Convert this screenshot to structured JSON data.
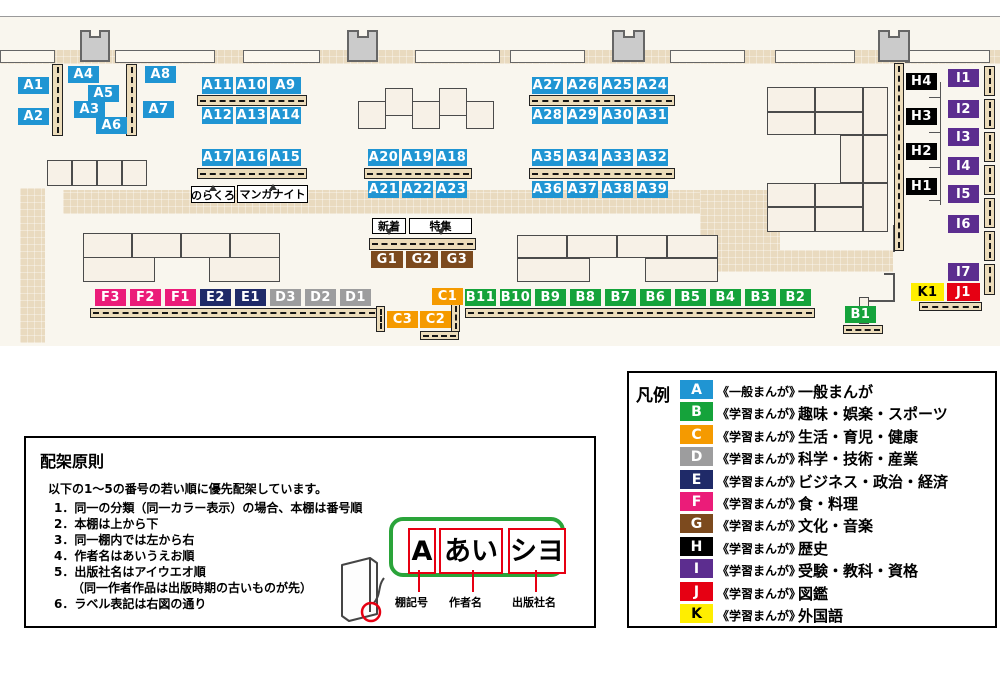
{
  "legend": {
    "title": "凡例",
    "entries": [
      {
        "key": "A",
        "color": "#2095d3",
        "letter": "#ffffff",
        "scope": "《一般まんが》",
        "category": "一般まんが"
      },
      {
        "key": "B",
        "color": "#15a33b",
        "letter": "#ffffff",
        "scope": "《学習まんが》",
        "category": "趣味・娯楽・スポーツ"
      },
      {
        "key": "C",
        "color": "#f59a00",
        "letter": "#ffffff",
        "scope": "《学習まんが》",
        "category": "生活・育児・健康"
      },
      {
        "key": "D",
        "color": "#9d9d9e",
        "letter": "#ffffff",
        "scope": "《学習まんが》",
        "category": "科学・技術・産業"
      },
      {
        "key": "E",
        "color": "#1f2a68",
        "letter": "#ffffff",
        "scope": "《学習まんが》",
        "category": "ビジネス・政治・経済"
      },
      {
        "key": "F",
        "color": "#eb1c79",
        "letter": "#ffffff",
        "scope": "《学習まんが》",
        "category": "食・料理"
      },
      {
        "key": "G",
        "color": "#7c4a1e",
        "letter": "#ffffff",
        "scope": "《学習まんが》",
        "category": "文化・音楽"
      },
      {
        "key": "H",
        "color": "#000000",
        "letter": "#ffffff",
        "scope": "《学習まんが》",
        "category": "歴史"
      },
      {
        "key": "I",
        "color": "#5c2d8f",
        "letter": "#ffffff",
        "scope": "《学習まんが》",
        "category": "受験・教科・資格"
      },
      {
        "key": "J",
        "color": "#e60013",
        "letter": "#ffffff",
        "scope": "《学習まんが》",
        "category": "図鑑"
      },
      {
        "key": "K",
        "color": "#ffee00",
        "letter": "#000000",
        "scope": "《学習まんが》",
        "category": "外国語"
      }
    ]
  },
  "principles": {
    "title": "配架原則",
    "intro": "以下の1～5の番号の若い順に優先配架しています。",
    "items": [
      "1．同一の分類（同一カラー表示）の場合、本棚は番号順",
      "2．本棚は上から下",
      "3．同一棚内では左から右",
      "4．作者名はあいうえお順",
      "5．出版社名はアイウエオ順",
      "　　（同一作者作品は出版時期の古いものが先）",
      "6．ラベル表記は右図の通り"
    ],
    "label_example": {
      "parts": [
        {
          "text": "A",
          "caption": "棚記号",
          "box": [
            15,
            7,
            28,
            46
          ],
          "cap_x": 369,
          "line_x": 392
        },
        {
          "text": "あい",
          "caption": "作者名",
          "box": [
            46,
            7,
            64,
            46
          ],
          "cap_x": 423,
          "line_x": 446
        },
        {
          "text": "シヨ",
          "caption": "出版社名",
          "box": [
            115,
            7,
            58,
            46
          ],
          "cap_x": 486,
          "line_x": 509
        }
      ],
      "cap_y": 156,
      "line_y": 132,
      "line_h": 22
    }
  },
  "map": {
    "colors": {
      "A": "#2095d3",
      "B": "#15a33b",
      "C": "#f59a00",
      "D": "#9d9d9e",
      "E": "#1f2a68",
      "F": "#eb1c79",
      "G": "#7c4a1e",
      "H": "#000000",
      "I": "#5c2d8f",
      "J": "#e60013",
      "K": "#ffee00"
    },
    "floor": [
      0,
      16,
      1000,
      330
    ],
    "topline": [
      0,
      16,
      1000,
      1
    ],
    "walkways": [
      [
        0,
        50,
        1000,
        14
      ],
      [
        63,
        190,
        660,
        24
      ],
      [
        700,
        190,
        80,
        82
      ],
      [
        700,
        250,
        193,
        22
      ],
      [
        20,
        188,
        25,
        155
      ]
    ],
    "walls": [
      [
        0,
        50,
        55,
        13
      ],
      [
        115,
        50,
        100,
        13
      ],
      [
        243,
        50,
        77,
        13
      ],
      [
        415,
        50,
        85,
        13
      ],
      [
        510,
        50,
        75,
        13
      ],
      [
        670,
        50,
        75,
        13
      ],
      [
        775,
        50,
        80,
        13
      ],
      [
        905,
        50,
        85,
        13
      ]
    ],
    "pillars": [
      [
        80,
        30,
        30,
        32
      ],
      [
        347,
        30,
        31,
        32
      ],
      [
        612,
        30,
        33,
        32
      ],
      [
        878,
        30,
        32,
        32
      ]
    ],
    "lines": [
      [
        893,
        225,
        2,
        27
      ],
      [
        893,
        274,
        2,
        28
      ],
      [
        884,
        273,
        11,
        2
      ],
      [
        868,
        300,
        27,
        2
      ],
      [
        940,
        82,
        1,
        123
      ],
      [
        929,
        97,
        11,
        1
      ],
      [
        929,
        132,
        11,
        1
      ],
      [
        929,
        167,
        11,
        1
      ],
      [
        929,
        200,
        11,
        1
      ]
    ],
    "tables": [
      [
        47,
        160,
        25,
        26
      ],
      [
        72,
        160,
        25,
        26
      ],
      [
        97,
        160,
        25,
        26
      ],
      [
        122,
        160,
        25,
        26
      ],
      [
        358,
        101,
        28,
        28
      ],
      [
        385,
        88,
        28,
        28
      ],
      [
        412,
        101,
        28,
        28
      ],
      [
        439,
        88,
        28,
        28
      ],
      [
        466,
        101,
        28,
        28
      ],
      [
        83,
        233,
        49,
        25
      ],
      [
        132,
        233,
        49,
        25
      ],
      [
        181,
        233,
        49,
        25
      ],
      [
        230,
        233,
        50,
        25
      ],
      [
        83,
        257,
        72,
        25
      ],
      [
        209,
        257,
        71,
        25
      ],
      [
        517,
        235,
        50,
        23
      ],
      [
        567,
        235,
        50,
        23
      ],
      [
        617,
        235,
        50,
        23
      ],
      [
        667,
        235,
        51,
        23
      ],
      [
        517,
        258,
        73,
        24
      ],
      [
        645,
        258,
        73,
        24
      ],
      [
        767,
        87,
        48,
        25
      ],
      [
        815,
        87,
        48,
        25
      ],
      [
        863,
        87,
        25,
        48
      ],
      [
        767,
        112,
        48,
        23
      ],
      [
        815,
        112,
        48,
        23
      ],
      [
        840,
        135,
        23,
        48
      ],
      [
        863,
        135,
        25,
        48
      ],
      [
        767,
        183,
        48,
        24
      ],
      [
        815,
        183,
        48,
        24
      ],
      [
        863,
        183,
        25,
        49
      ],
      [
        767,
        207,
        48,
        25
      ],
      [
        815,
        207,
        48,
        25
      ],
      [
        859,
        297,
        10,
        27
      ]
    ],
    "bookcases": [
      [
        52,
        64,
        11,
        72,
        "v"
      ],
      [
        126,
        64,
        11,
        72,
        "v"
      ],
      [
        197,
        95,
        110,
        11,
        "h"
      ],
      [
        197,
        168,
        110,
        11,
        "h"
      ],
      [
        364,
        168,
        108,
        11,
        "h"
      ],
      [
        529,
        95,
        146,
        11,
        "h"
      ],
      [
        529,
        168,
        146,
        11,
        "h"
      ],
      [
        369,
        238,
        107,
        12,
        "h"
      ],
      [
        90,
        308,
        288,
        10,
        "h"
      ],
      [
        376,
        306,
        9,
        26,
        "v"
      ],
      [
        465,
        308,
        350,
        10,
        "h"
      ],
      [
        420,
        331,
        39,
        9,
        "h"
      ],
      [
        451,
        303,
        9,
        29,
        "v"
      ],
      [
        843,
        325,
        40,
        9,
        "h"
      ],
      [
        919,
        302,
        63,
        9,
        "h"
      ],
      [
        894,
        63,
        10,
        188,
        "v"
      ],
      [
        984,
        66,
        11,
        30,
        "v"
      ],
      [
        984,
        99,
        11,
        30,
        "v"
      ],
      [
        984,
        132,
        11,
        30,
        "v"
      ],
      [
        984,
        165,
        11,
        30,
        "v"
      ],
      [
        984,
        198,
        11,
        30,
        "v"
      ],
      [
        984,
        231,
        11,
        30,
        "v"
      ],
      [
        984,
        264,
        11,
        31,
        "v"
      ]
    ],
    "shelf_labels": [
      {
        "id": "A1",
        "c": "A",
        "x": 18,
        "y": 77
      },
      {
        "id": "A2",
        "c": "A",
        "x": 18,
        "y": 108
      },
      {
        "id": "A4",
        "c": "A",
        "x": 68,
        "y": 66
      },
      {
        "id": "A5",
        "c": "A",
        "x": 88,
        "y": 85
      },
      {
        "id": "A3",
        "c": "A",
        "x": 74,
        "y": 101
      },
      {
        "id": "A6",
        "c": "A",
        "x": 96,
        "y": 117
      },
      {
        "id": "A8",
        "c": "A",
        "x": 145,
        "y": 66
      },
      {
        "id": "A7",
        "c": "A",
        "x": 143,
        "y": 101
      },
      {
        "id": "A11",
        "c": "A",
        "x": 202,
        "y": 77
      },
      {
        "id": "A10",
        "c": "A",
        "x": 236,
        "y": 77
      },
      {
        "id": "A9",
        "c": "A",
        "x": 270,
        "y": 77
      },
      {
        "id": "A12",
        "c": "A",
        "x": 202,
        "y": 107
      },
      {
        "id": "A13",
        "c": "A",
        "x": 236,
        "y": 107
      },
      {
        "id": "A14",
        "c": "A",
        "x": 270,
        "y": 107
      },
      {
        "id": "A17",
        "c": "A",
        "x": 202,
        "y": 149
      },
      {
        "id": "A16",
        "c": "A",
        "x": 236,
        "y": 149
      },
      {
        "id": "A15",
        "c": "A",
        "x": 270,
        "y": 149
      },
      {
        "id": "A20",
        "c": "A",
        "x": 368,
        "y": 149
      },
      {
        "id": "A19",
        "c": "A",
        "x": 402,
        "y": 149
      },
      {
        "id": "A18",
        "c": "A",
        "x": 436,
        "y": 149
      },
      {
        "id": "A21",
        "c": "A",
        "x": 368,
        "y": 181
      },
      {
        "id": "A22",
        "c": "A",
        "x": 402,
        "y": 181
      },
      {
        "id": "A23",
        "c": "A",
        "x": 436,
        "y": 181
      },
      {
        "id": "A27",
        "c": "A",
        "x": 532,
        "y": 77
      },
      {
        "id": "A26",
        "c": "A",
        "x": 567,
        "y": 77
      },
      {
        "id": "A25",
        "c": "A",
        "x": 602,
        "y": 77
      },
      {
        "id": "A24",
        "c": "A",
        "x": 637,
        "y": 77
      },
      {
        "id": "A28",
        "c": "A",
        "x": 532,
        "y": 107
      },
      {
        "id": "A29",
        "c": "A",
        "x": 567,
        "y": 107
      },
      {
        "id": "A30",
        "c": "A",
        "x": 602,
        "y": 107
      },
      {
        "id": "A31",
        "c": "A",
        "x": 637,
        "y": 107
      },
      {
        "id": "A35",
        "c": "A",
        "x": 532,
        "y": 149
      },
      {
        "id": "A34",
        "c": "A",
        "x": 567,
        "y": 149
      },
      {
        "id": "A33",
        "c": "A",
        "x": 602,
        "y": 149
      },
      {
        "id": "A32",
        "c": "A",
        "x": 637,
        "y": 149
      },
      {
        "id": "A36",
        "c": "A",
        "x": 532,
        "y": 181
      },
      {
        "id": "A37",
        "c": "A",
        "x": 567,
        "y": 181
      },
      {
        "id": "A38",
        "c": "A",
        "x": 602,
        "y": 181
      },
      {
        "id": "A39",
        "c": "A",
        "x": 637,
        "y": 181
      },
      {
        "id": "G1",
        "c": "G",
        "x": 371,
        "y": 251,
        "w": 32
      },
      {
        "id": "G2",
        "c": "G",
        "x": 406,
        "y": 251,
        "w": 32
      },
      {
        "id": "G3",
        "c": "G",
        "x": 441,
        "y": 251,
        "w": 32
      },
      {
        "id": "F3",
        "c": "F",
        "x": 95,
        "y": 289
      },
      {
        "id": "F2",
        "c": "F",
        "x": 130,
        "y": 289
      },
      {
        "id": "F1",
        "c": "F",
        "x": 165,
        "y": 289
      },
      {
        "id": "E2",
        "c": "E",
        "x": 200,
        "y": 289
      },
      {
        "id": "E1",
        "c": "E",
        "x": 235,
        "y": 289
      },
      {
        "id": "D3",
        "c": "D",
        "x": 270,
        "y": 289
      },
      {
        "id": "D2",
        "c": "D",
        "x": 305,
        "y": 289
      },
      {
        "id": "D1",
        "c": "D",
        "x": 340,
        "y": 289
      },
      {
        "id": "C1",
        "c": "C",
        "x": 432,
        "y": 288
      },
      {
        "id": "C3",
        "c": "C",
        "x": 387,
        "y": 311
      },
      {
        "id": "C2",
        "c": "C",
        "x": 420,
        "y": 311
      },
      {
        "id": "B11",
        "c": "B",
        "x": 465,
        "y": 289
      },
      {
        "id": "B10",
        "c": "B",
        "x": 500,
        "y": 289
      },
      {
        "id": "B9",
        "c": "B",
        "x": 535,
        "y": 289
      },
      {
        "id": "B8",
        "c": "B",
        "x": 570,
        "y": 289
      },
      {
        "id": "B7",
        "c": "B",
        "x": 605,
        "y": 289
      },
      {
        "id": "B6",
        "c": "B",
        "x": 640,
        "y": 289
      },
      {
        "id": "B5",
        "c": "B",
        "x": 675,
        "y": 289
      },
      {
        "id": "B4",
        "c": "B",
        "x": 710,
        "y": 289
      },
      {
        "id": "B3",
        "c": "B",
        "x": 745,
        "y": 289
      },
      {
        "id": "B2",
        "c": "B",
        "x": 780,
        "y": 289
      },
      {
        "id": "B1",
        "c": "B",
        "x": 845,
        "y": 306
      },
      {
        "id": "H4",
        "c": "H",
        "x": 906,
        "y": 73
      },
      {
        "id": "H3",
        "c": "H",
        "x": 906,
        "y": 108
      },
      {
        "id": "H2",
        "c": "H",
        "x": 906,
        "y": 143
      },
      {
        "id": "H1",
        "c": "H",
        "x": 906,
        "y": 178
      },
      {
        "id": "I1",
        "c": "I",
        "x": 948,
        "y": 69,
        "h": 18
      },
      {
        "id": "I2",
        "c": "I",
        "x": 948,
        "y": 100,
        "h": 18
      },
      {
        "id": "I3",
        "c": "I",
        "x": 948,
        "y": 128,
        "h": 18
      },
      {
        "id": "I4",
        "c": "I",
        "x": 948,
        "y": 157,
        "h": 18
      },
      {
        "id": "I5",
        "c": "I",
        "x": 948,
        "y": 185,
        "h": 18
      },
      {
        "id": "I6",
        "c": "I",
        "x": 948,
        "y": 215,
        "h": 18
      },
      {
        "id": "I7",
        "c": "I",
        "x": 948,
        "y": 263,
        "h": 18
      },
      {
        "id": "K1",
        "c": "K",
        "x": 911,
        "y": 283,
        "w": 33,
        "h": 18
      },
      {
        "id": "J1",
        "c": "J",
        "x": 947,
        "y": 283,
        "w": 33,
        "h": 18
      }
    ],
    "area_labels": [
      {
        "text": "のらくろ",
        "x": 191,
        "y": 186,
        "w": 44,
        "h": 17,
        "tail": "up"
      },
      {
        "text": "マンガナイト",
        "x": 237,
        "y": 185,
        "w": 71,
        "h": 18,
        "tail": "up"
      },
      {
        "text": "新着",
        "x": 372,
        "y": 218,
        "w": 34,
        "h": 16,
        "tail": "down"
      },
      {
        "text": "特集",
        "x": 409,
        "y": 218,
        "w": 63,
        "h": 16,
        "tail": "down"
      }
    ]
  }
}
